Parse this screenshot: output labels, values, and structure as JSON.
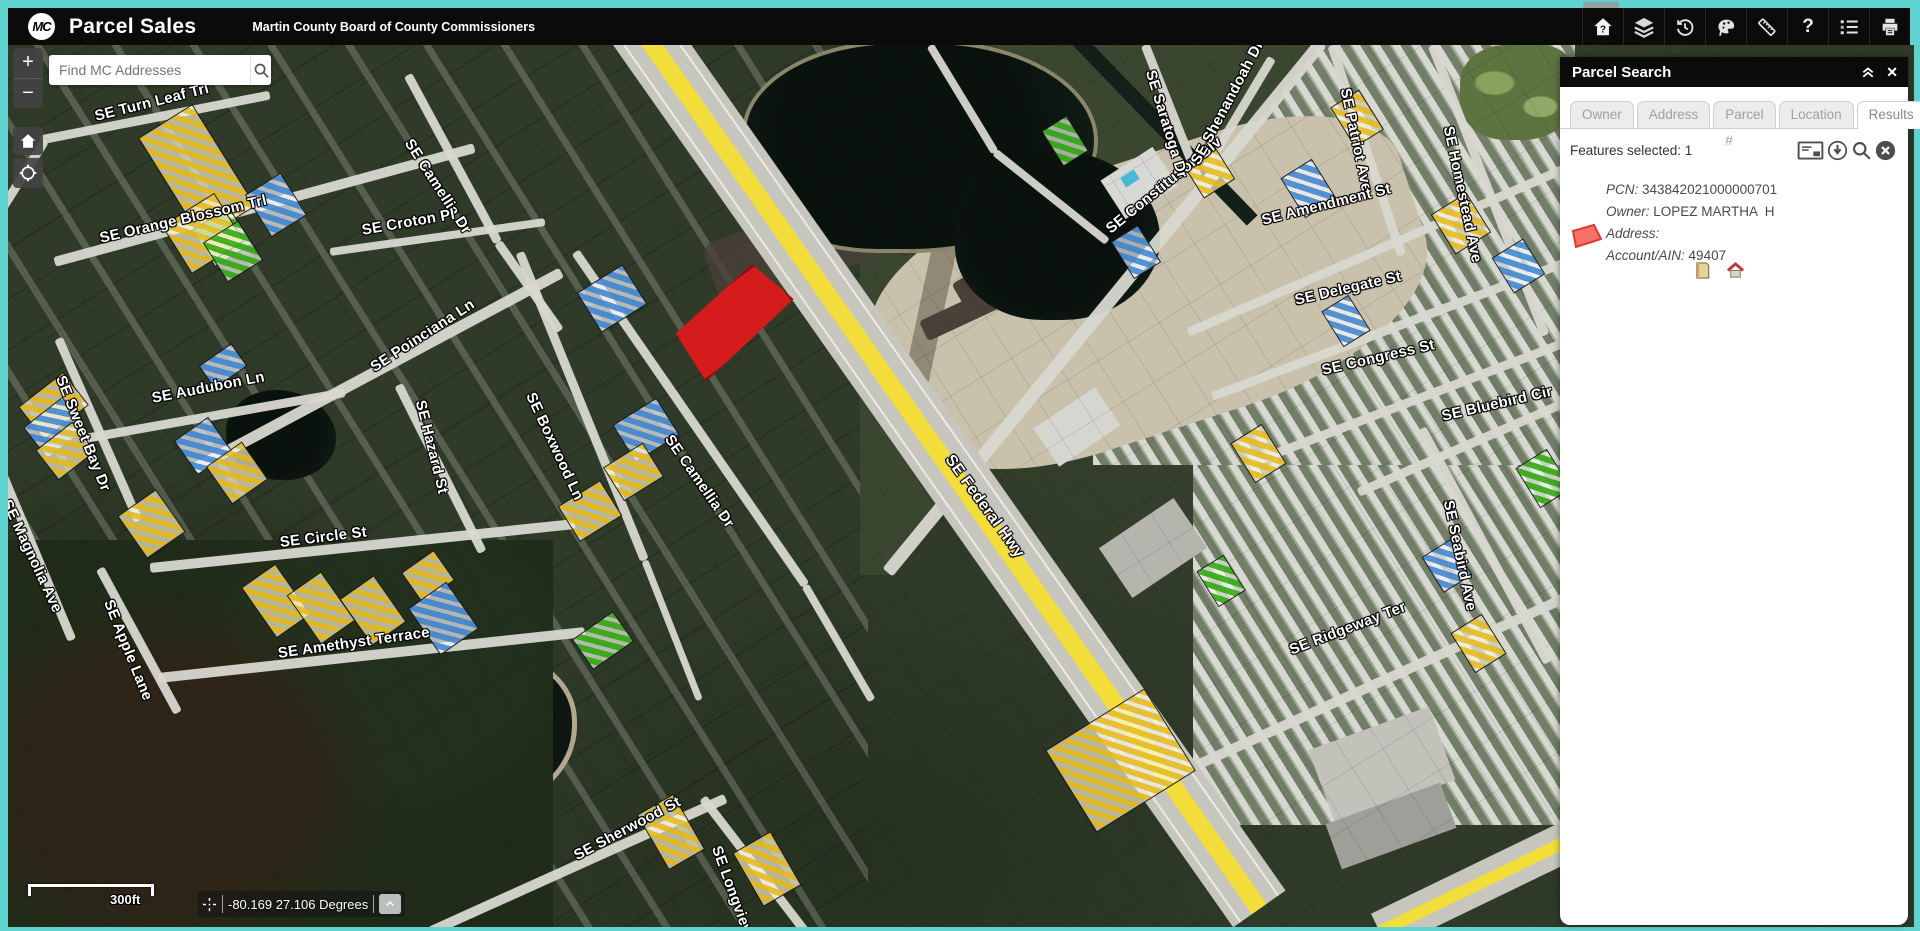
{
  "app": {
    "logo": "MC",
    "title": "Parcel Sales",
    "subtitle": "Martin County Board of County Commissioners"
  },
  "toolbar": {
    "buttons": [
      "home-question",
      "layers",
      "history",
      "draw",
      "measure",
      "help",
      "legend",
      "print"
    ]
  },
  "search": {
    "placeholder": "Find MC Addresses"
  },
  "map": {
    "controls": {
      "zoom_in": "+",
      "zoom_out": "−"
    },
    "scale_label": "300ft",
    "coordinates": "-80.169 27.106 Degrees",
    "street_labels": [
      {
        "text": "SE Turn Leaf Trl",
        "x": 87,
        "y": 63,
        "r": -14
      },
      {
        "text": "SE Orange Blossom Trl",
        "x": 92,
        "y": 185,
        "r": -13
      },
      {
        "text": "SE Camellia Dr",
        "x": 400,
        "y": 87,
        "r": 57
      },
      {
        "text": "SE Croton Pl",
        "x": 354,
        "y": 177,
        "r": -10
      },
      {
        "text": "SE Poinciana Ln",
        "x": 364,
        "y": 315,
        "r": -33
      },
      {
        "text": "SE Audubon Ln",
        "x": 144,
        "y": 345,
        "r": -11
      },
      {
        "text": "SE Sweet Bay Dr",
        "x": 52,
        "y": 323,
        "r": 68
      },
      {
        "text": "SE Magnolia Ave",
        "x": -2,
        "y": 447,
        "r": 65
      },
      {
        "text": "SE Hazard St",
        "x": 412,
        "y": 347,
        "r": 76
      },
      {
        "text": "SE Boxwood Ln",
        "x": 522,
        "y": 340,
        "r": 65
      },
      {
        "text": "SE Camellia Dr",
        "x": 660,
        "y": 383,
        "r": 55
      },
      {
        "text": "SE Circle St",
        "x": 272,
        "y": 489,
        "r": -7
      },
      {
        "text": "SE Apple Lane",
        "x": 100,
        "y": 547,
        "r": 68
      },
      {
        "text": "SE Amethyst Terrace",
        "x": 270,
        "y": 600,
        "r": -8
      },
      {
        "text": "SE Sherwood St",
        "x": 567,
        "y": 803,
        "r": -28
      },
      {
        "text": "SE Longview Dr",
        "x": 708,
        "y": 793,
        "r": 70
      },
      {
        "text": "SE Federal Hwy",
        "x": 940,
        "y": 403,
        "r": 54,
        "fs": 16
      },
      {
        "text": "SE Constitution Blv",
        "x": 1100,
        "y": 177,
        "r": -39
      },
      {
        "text": "SE Saratoga Dr",
        "x": 1142,
        "y": 17,
        "r": 73
      },
      {
        "text": "SE Shenandoah Dr",
        "x": 1187,
        "y": 110,
        "r": -62
      },
      {
        "text": "SE Patriot Ave",
        "x": 1337,
        "y": 35,
        "r": 78
      },
      {
        "text": "SE Homestead Ave",
        "x": 1440,
        "y": 73,
        "r": 78
      },
      {
        "text": "SE Amendment St",
        "x": 1254,
        "y": 167,
        "r": -14
      },
      {
        "text": "SE Delegate St",
        "x": 1287,
        "y": 247,
        "r": -13
      },
      {
        "text": "SE Congress St",
        "x": 1314,
        "y": 317,
        "r": -13
      },
      {
        "text": "SE Bluebird Cir",
        "x": 1434,
        "y": 363,
        "r": -13
      },
      {
        "text": "SE Seabird Ave",
        "x": 1440,
        "y": 447,
        "r": 78
      },
      {
        "text": "SE Ridgeway Ter",
        "x": 1282,
        "y": 597,
        "r": -21
      }
    ],
    "hatches": [
      {
        "x": 157,
        "y": 67,
        "w": 62,
        "h": 118,
        "r": -32,
        "c": "y"
      },
      {
        "x": 192,
        "y": 170,
        "w": 42,
        "h": 42,
        "r": -32,
        "c": "g"
      },
      {
        "x": 247,
        "y": 135,
        "w": 40,
        "h": 48,
        "r": -32,
        "c": "b"
      },
      {
        "x": 164,
        "y": 160,
        "w": 60,
        "h": 55,
        "r": -32,
        "c": "y"
      },
      {
        "x": 204,
        "y": 183,
        "w": 40,
        "h": 45,
        "r": -32,
        "c": "g"
      },
      {
        "x": 17,
        "y": 340,
        "w": 55,
        "h": 40,
        "r": -38,
        "c": "y"
      },
      {
        "x": 22,
        "y": 363,
        "w": 48,
        "h": 38,
        "r": -38,
        "c": "b"
      },
      {
        "x": 34,
        "y": 387,
        "w": 45,
        "h": 36,
        "r": -38,
        "c": "y"
      },
      {
        "x": 195,
        "y": 307,
        "w": 38,
        "h": 26,
        "r": -35,
        "c": "b"
      },
      {
        "x": 174,
        "y": 380,
        "w": 40,
        "h": 40,
        "r": -35,
        "c": "b"
      },
      {
        "x": 207,
        "y": 405,
        "w": 42,
        "h": 44,
        "r": -35,
        "c": "y"
      },
      {
        "x": 120,
        "y": 453,
        "w": 45,
        "h": 50,
        "r": -35,
        "c": "y"
      },
      {
        "x": 400,
        "y": 513,
        "w": 38,
        "h": 35,
        "r": -35,
        "c": "y"
      },
      {
        "x": 577,
        "y": 230,
        "w": 52,
        "h": 45,
        "r": -32,
        "c": "b"
      },
      {
        "x": 612,
        "y": 363,
        "w": 50,
        "h": 42,
        "r": -32,
        "c": "b"
      },
      {
        "x": 602,
        "y": 407,
        "w": 45,
        "h": 38,
        "r": -32,
        "c": "y"
      },
      {
        "x": 557,
        "y": 445,
        "w": 48,
        "h": 40,
        "r": -32,
        "c": "y"
      },
      {
        "x": 247,
        "y": 525,
        "w": 40,
        "h": 60,
        "r": -35,
        "c": "y"
      },
      {
        "x": 292,
        "y": 533,
        "w": 40,
        "h": 58,
        "r": -35,
        "c": "y"
      },
      {
        "x": 344,
        "y": 537,
        "w": 40,
        "h": 55,
        "r": -35,
        "c": "y"
      },
      {
        "x": 412,
        "y": 545,
        "w": 45,
        "h": 55,
        "r": -35,
        "c": "b"
      },
      {
        "x": 570,
        "y": 577,
        "w": 48,
        "h": 35,
        "r": -35,
        "c": "g"
      },
      {
        "x": 642,
        "y": 755,
        "w": 40,
        "h": 62,
        "r": -30,
        "c": "y"
      },
      {
        "x": 737,
        "y": 793,
        "w": 42,
        "h": 60,
        "r": -30,
        "c": "y"
      },
      {
        "x": 1054,
        "y": 667,
        "w": 115,
        "h": 95,
        "r": -32,
        "c": "y"
      },
      {
        "x": 1182,
        "y": 105,
        "w": 35,
        "h": 40,
        "r": -32,
        "c": "y"
      },
      {
        "x": 1282,
        "y": 120,
        "w": 35,
        "h": 45,
        "r": -32,
        "c": "b"
      },
      {
        "x": 1432,
        "y": 155,
        "w": 40,
        "h": 45,
        "r": -32,
        "c": "y"
      },
      {
        "x": 1492,
        "y": 200,
        "w": 35,
        "h": 40,
        "r": -32,
        "c": "b"
      },
      {
        "x": 1517,
        "y": 410,
        "w": 35,
        "h": 45,
        "r": -32,
        "c": "g"
      },
      {
        "x": 1232,
        "y": 385,
        "w": 35,
        "h": 45,
        "r": -32,
        "c": "y"
      },
      {
        "x": 1322,
        "y": 255,
        "w": 30,
        "h": 40,
        "r": -32,
        "c": "b"
      },
      {
        "x": 1452,
        "y": 575,
        "w": 35,
        "h": 45,
        "r": -32,
        "c": "y"
      },
      {
        "x": 1197,
        "y": 515,
        "w": 30,
        "h": 40,
        "r": -32,
        "c": "g"
      },
      {
        "x": 1422,
        "y": 500,
        "w": 32,
        "h": 40,
        "r": -32,
        "c": "b"
      },
      {
        "x": 1332,
        "y": 50,
        "w": 32,
        "h": 45,
        "r": -32,
        "c": "y"
      },
      {
        "x": 1042,
        "y": 75,
        "w": 28,
        "h": 40,
        "r": -32,
        "c": "g"
      },
      {
        "x": 1112,
        "y": 185,
        "w": 30,
        "h": 42,
        "r": -32,
        "c": "b"
      }
    ]
  },
  "panel": {
    "title": "Parcel Search",
    "tabs": [
      {
        "label": "Owner",
        "active": false
      },
      {
        "label": "Address",
        "active": false
      },
      {
        "label": "Parcel #",
        "active": false
      },
      {
        "label": "Location",
        "active": false
      },
      {
        "label": "Results",
        "active": true
      }
    ],
    "results": {
      "features_selected": "Features selected: 1",
      "item": {
        "pcn_label": "PCN:",
        "pcn_value": " 343842021000000701",
        "owner_label": "Owner:",
        "owner_value": " LOPEZ MARTHA  H",
        "address_label": "Address:",
        "address_value": "",
        "account_label": "Account/AIN:",
        "account_value": " 49407"
      }
    }
  },
  "colors": {
    "accent_teal": "#5fd3cf",
    "header_bg": "#0b0b0b",
    "highway_yellow": "#f2dd3b",
    "selection_red": "#d41c1c",
    "hatch_yellow": "#e7bf2e",
    "hatch_blue": "#4d8fd6",
    "hatch_green": "#3fae1f"
  }
}
